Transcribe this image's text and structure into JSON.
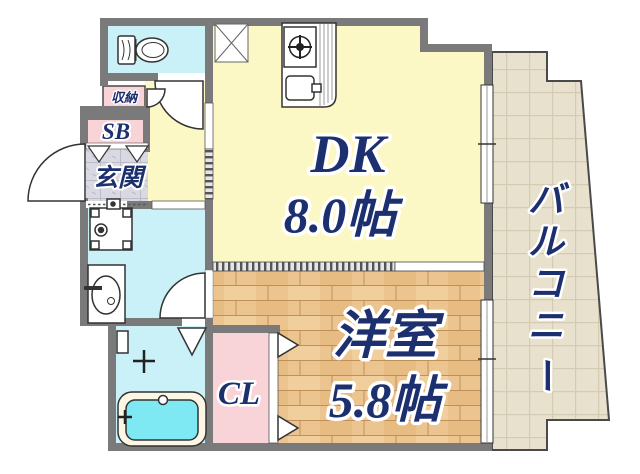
{
  "plan": {
    "title": "apartment-floor-plan",
    "rooms": {
      "dk": {
        "label": "DK",
        "size": "8.0帖"
      },
      "western": {
        "label": "洋室",
        "size": "5.8帖"
      },
      "balcony": {
        "label": "バルコニー",
        "chars": [
          "バ",
          "ル",
          "コ",
          "ニ",
          "ー"
        ]
      },
      "entrance": {
        "label": "玄関"
      },
      "shoe_box": {
        "label": "SB"
      },
      "storage": {
        "label": "収納"
      },
      "closet": {
        "label": "CL"
      }
    },
    "colors": {
      "wall": "#7a7a7a",
      "dk_fill": "#fcf8c5",
      "wet_fill": "#c9f1f7",
      "pink_fill": "#f8d4d9",
      "wood_base": "#ecc48f",
      "balcony_base": "#e8e1cd",
      "entrance_base": "#d9d9e1",
      "tub_fill": "#7ee9f2",
      "text_navy": "#1c2f6e"
    }
  }
}
